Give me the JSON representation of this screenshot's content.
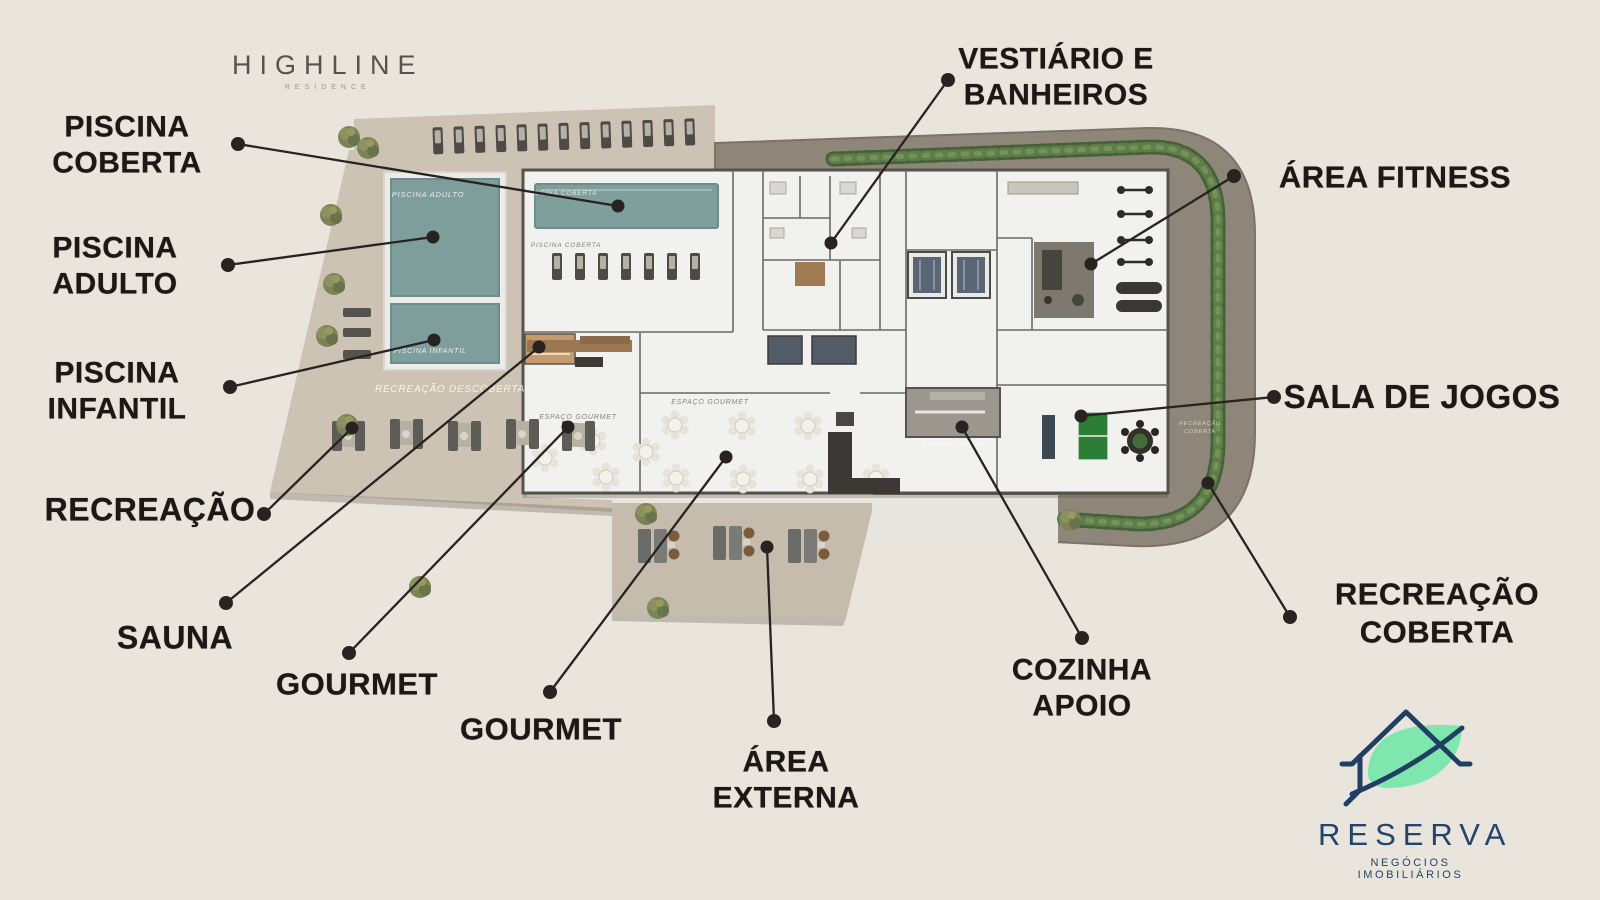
{
  "branding": {
    "highline": {
      "name": "HIGHLINE",
      "subtitle": "RESIDENCE"
    },
    "reserva": {
      "name": "RESERVA",
      "subtitle": "NEGÓCIOS IMOBILIÁRIOS"
    }
  },
  "colors": {
    "background": "#e9e4dc",
    "label_text": "#1b1815",
    "leader": "#282320",
    "deck_tan": "#cdc3b4",
    "path_brown": "#8e8679",
    "building_white": "#f1f1ef",
    "pool_teal": "#7d9e9b",
    "hedge_green": "#567344",
    "pingpong_green": "#2c7d35",
    "logo_navy": "#23456a",
    "logo_leaf": "#7fe7ae"
  },
  "callouts": [
    {
      "id": "piscina-coberta",
      "lines": [
        "PISCINA",
        "COBERTA"
      ],
      "cx": 127,
      "cy": 146,
      "size": 30,
      "dot": [
        238,
        144
      ],
      "target": [
        618,
        206
      ]
    },
    {
      "id": "piscina-adulto",
      "lines": [
        "PISCINA",
        "ADULTO"
      ],
      "cx": 115,
      "cy": 267,
      "size": 30,
      "dot": [
        228,
        265
      ],
      "target": [
        433,
        237
      ]
    },
    {
      "id": "piscina-infantil",
      "lines": [
        "PISCINA",
        "INFANTIL"
      ],
      "cx": 117,
      "cy": 392,
      "size": 30,
      "dot": [
        230,
        387
      ],
      "target": [
        434,
        340
      ]
    },
    {
      "id": "recreacao",
      "lines": [
        "RECREAÇÃO"
      ],
      "cx": 150,
      "cy": 510,
      "size": 32,
      "dot": [
        264,
        514
      ],
      "target": [
        352,
        428
      ]
    },
    {
      "id": "sauna",
      "lines": [
        "SAUNA"
      ],
      "cx": 175,
      "cy": 638,
      "size": 32,
      "dot": [
        226,
        603
      ],
      "target": [
        539,
        347
      ]
    },
    {
      "id": "gourmet-1",
      "lines": [
        "GOURMET"
      ],
      "cx": 357,
      "cy": 684,
      "size": 31,
      "dot": [
        349,
        653
      ],
      "target": [
        568,
        427
      ]
    },
    {
      "id": "gourmet-2",
      "lines": [
        "GOURMET"
      ],
      "cx": 541,
      "cy": 729,
      "size": 31,
      "dot": [
        550,
        692
      ],
      "target": [
        726,
        457
      ]
    },
    {
      "id": "area-externa",
      "lines": [
        "ÁREA",
        "EXTERNA"
      ],
      "cx": 786,
      "cy": 781,
      "size": 30,
      "dot": [
        774,
        721
      ],
      "target": [
        767,
        547
      ]
    },
    {
      "id": "vestiario-banheiros",
      "lines": [
        "VESTIÁRIO E",
        "BANHEIROS"
      ],
      "cx": 1056,
      "cy": 78,
      "size": 30,
      "dot": [
        948,
        80
      ],
      "target": [
        831,
        243
      ]
    },
    {
      "id": "area-fitness",
      "lines": [
        "ÁREA FITNESS"
      ],
      "cx": 1395,
      "cy": 177,
      "size": 31,
      "dot": [
        1234,
        176
      ],
      "target": [
        1091,
        264
      ]
    },
    {
      "id": "sala-de-jogos",
      "lines": [
        "SALA DE JOGOS"
      ],
      "cx": 1422,
      "cy": 397,
      "size": 33,
      "dot": [
        1274,
        397
      ],
      "target": [
        1081,
        416
      ]
    },
    {
      "id": "recreacao-coberta",
      "lines": [
        "RECREAÇÃO",
        "COBERTA"
      ],
      "cx": 1437,
      "cy": 613,
      "size": 31,
      "dot": [
        1290,
        617
      ],
      "target": [
        1208,
        483
      ]
    },
    {
      "id": "cozinha-apoio",
      "lines": [
        "COZINHA",
        "APOIO"
      ],
      "cx": 1082,
      "cy": 689,
      "size": 30,
      "dot": [
        1082,
        638
      ],
      "target": [
        962,
        427
      ]
    }
  ],
  "plan_labels": [
    {
      "text": "PISCINA ADULTO",
      "x": 428,
      "y": 197,
      "size": 7.5,
      "color": "rgba(255,255,255,0.85)",
      "italic": true
    },
    {
      "text": "PISCINA INFANTIL",
      "x": 430,
      "y": 353,
      "size": 7,
      "color": "rgba(255,255,255,0.85)",
      "italic": true
    },
    {
      "text": "RECREAÇÃO DESCOBERTA",
      "x": 450,
      "y": 392,
      "size": 10,
      "color": "rgba(255,255,250,0.8)",
      "italic": true
    },
    {
      "text": "PISCINA COBERTA",
      "x": 562,
      "y": 195,
      "size": 6.5,
      "color": "rgba(255,255,255,0.8)",
      "italic": true
    },
    {
      "text": "PISCINA COBERTA",
      "x": 566,
      "y": 247,
      "size": 6.5,
      "color": "rgba(90,90,88,0.75)",
      "italic": true
    },
    {
      "text": "ESPAÇO GOURMET",
      "x": 578,
      "y": 419,
      "size": 7,
      "color": "rgba(110,110,108,0.85)",
      "italic": true
    },
    {
      "text": "ESPAÇO GOURMET",
      "x": 710,
      "y": 404,
      "size": 7,
      "color": "rgba(110,110,108,0.85)",
      "italic": true
    },
    {
      "text": "COZINHA APOIO",
      "x": 953,
      "y": 446,
      "size": 6.5,
      "color": "rgba(255,255,255,0.85)",
      "italic": true
    },
    {
      "text": "RECREAÇÃO",
      "x": 1200,
      "y": 425,
      "size": 5.5,
      "color": "rgba(255,255,255,0.6)",
      "italic": true
    },
    {
      "text": "COBERTA",
      "x": 1200,
      "y": 433,
      "size": 5.5,
      "color": "rgba(255,255,255,0.6)",
      "italic": true
    }
  ]
}
